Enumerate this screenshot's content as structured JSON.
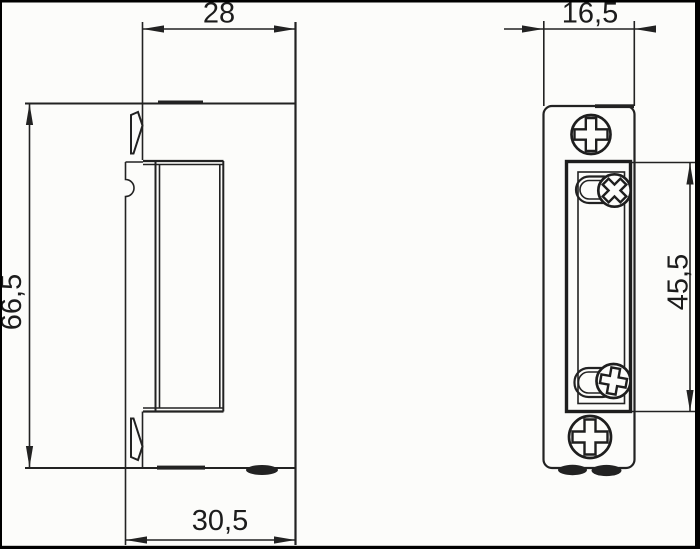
{
  "drawing": {
    "kind": "technical-dimensional-drawing",
    "subject": "door strike (side view and faceplate front view)",
    "colors": {
      "line": "#222222",
      "background": "#fcfcfa",
      "border": "#000000",
      "dark_fill": "#262626"
    },
    "side_view": {
      "dims": {
        "body_width": "28",
        "overall_height": "66,5",
        "overall_depth": "30,5"
      }
    },
    "front_view": {
      "dims": {
        "faceplate_width": "16,5",
        "opening_height": "45,5"
      }
    }
  }
}
